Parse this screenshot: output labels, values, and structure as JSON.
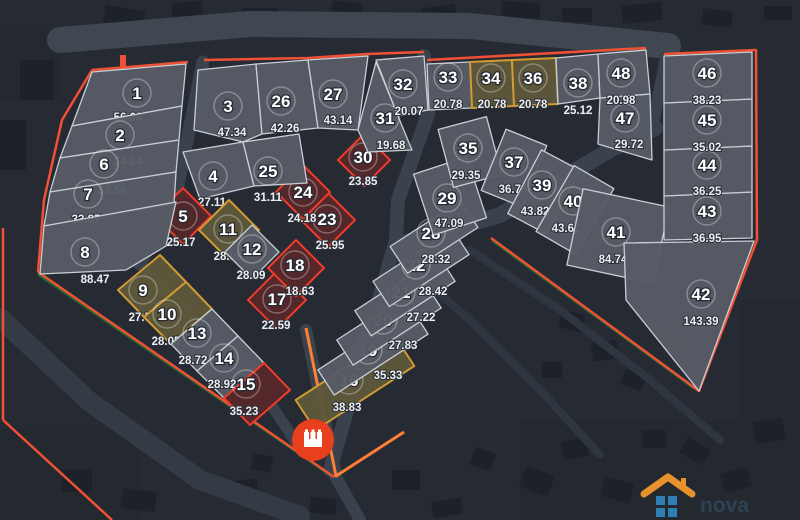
{
  "map": {
    "background": "#262b33",
    "road_color": "#3a424e",
    "perimeter_color": "#f05033",
    "accent_orange": "#ff7f35",
    "green_line_color": "#1e6b33",
    "number_ring_color": "rgba(255,255,255,0.30)",
    "variants": {
      "gray": {
        "fill": "#565c65",
        "stroke": "#c9ced6"
      },
      "red": {
        "fill": "#56282a",
        "stroke": "#ee3b2b"
      },
      "olive": {
        "fill": "#5e573a",
        "stroke": "#d09a34"
      }
    }
  },
  "marker": {
    "color": "#e8401f",
    "icon": "castle-icon"
  },
  "logo": {
    "wordmark": "nova",
    "roof_color": "#e8922e",
    "squares_color": "#2f7fb5"
  },
  "plots": [
    {
      "n": "1",
      "area": "56.00",
      "variant": "gray"
    },
    {
      "n": "2",
      "area": "24.84",
      "variant": "gray"
    },
    {
      "n": "3",
      "area": "47.34",
      "variant": "gray"
    },
    {
      "n": "4",
      "area": "27.11",
      "variant": "gray"
    },
    {
      "n": "5",
      "area": "25.17",
      "variant": "red"
    },
    {
      "n": "6",
      "area": "33.50",
      "variant": "gray"
    },
    {
      "n": "7",
      "area": "33.87",
      "variant": "gray"
    },
    {
      "n": "8",
      "area": "88.47",
      "variant": "gray"
    },
    {
      "n": "9",
      "area": "27.53",
      "variant": "olive"
    },
    {
      "n": "10",
      "area": "28.05",
      "variant": "olive"
    },
    {
      "n": "11",
      "area": "28.09",
      "variant": "olive"
    },
    {
      "n": "12",
      "area": "28.09",
      "variant": "gray"
    },
    {
      "n": "13",
      "area": "28.72",
      "variant": "gray"
    },
    {
      "n": "14",
      "area": "28.92",
      "variant": "gray"
    },
    {
      "n": "15",
      "area": "35.23",
      "variant": "red"
    },
    {
      "n": "16",
      "area": "38.83",
      "variant": "olive"
    },
    {
      "n": "17",
      "area": "22.59",
      "variant": "red"
    },
    {
      "n": "18",
      "area": "18.63",
      "variant": "red"
    },
    {
      "n": "19",
      "area": "35.33",
      "variant": "gray"
    },
    {
      "n": "20",
      "area": "27.83",
      "variant": "gray"
    },
    {
      "n": "21",
      "area": "27.22",
      "variant": "gray"
    },
    {
      "n": "22",
      "area": "28.42",
      "variant": "gray"
    },
    {
      "n": "23",
      "area": "25.95",
      "variant": "red"
    },
    {
      "n": "24",
      "area": "24.18",
      "variant": "red"
    },
    {
      "n": "25",
      "area": "31.11",
      "variant": "gray"
    },
    {
      "n": "26",
      "area": "42.26",
      "variant": "gray"
    },
    {
      "n": "27",
      "area": "43.14",
      "variant": "gray"
    },
    {
      "n": "28",
      "area": "28.32",
      "variant": "gray"
    },
    {
      "n": "29",
      "area": "47.09",
      "variant": "gray"
    },
    {
      "n": "30",
      "area": "23.85",
      "variant": "red"
    },
    {
      "n": "31",
      "area": "19.68",
      "variant": "gray"
    },
    {
      "n": "32",
      "area": "20.07",
      "variant": "gray"
    },
    {
      "n": "33",
      "area": "20.78",
      "variant": "gray"
    },
    {
      "n": "34",
      "area": "20.78",
      "variant": "olive"
    },
    {
      "n": "35",
      "area": "29.35",
      "variant": "gray"
    },
    {
      "n": "36",
      "area": "20.78",
      "variant": "olive"
    },
    {
      "n": "37",
      "area": "36.78",
      "variant": "gray"
    },
    {
      "n": "38",
      "area": "25.12",
      "variant": "gray"
    },
    {
      "n": "39",
      "area": "43.82",
      "variant": "gray"
    },
    {
      "n": "40",
      "area": "43.61",
      "variant": "gray"
    },
    {
      "n": "41",
      "area": "84.74",
      "variant": "gray"
    },
    {
      "n": "42",
      "area": "143.39",
      "variant": "gray"
    },
    {
      "n": "43",
      "area": "36.95",
      "variant": "gray"
    },
    {
      "n": "44",
      "area": "36.25",
      "variant": "gray"
    },
    {
      "n": "45",
      "area": "35.02",
      "variant": "gray"
    },
    {
      "n": "46",
      "area": "38.23",
      "variant": "gray"
    },
    {
      "n": "47",
      "area": "29.72",
      "variant": "gray"
    },
    {
      "n": "48",
      "area": "20.98",
      "variant": "gray"
    }
  ]
}
